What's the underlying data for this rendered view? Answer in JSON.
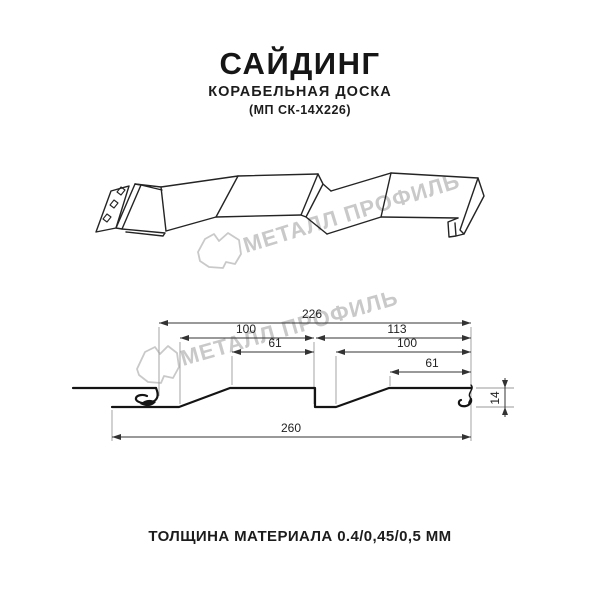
{
  "header": {
    "title": "САЙДИНГ",
    "subtitle": "КОРАБЕЛЬНАЯ ДОСКА",
    "model": "(МП СК-14Х226)"
  },
  "watermark": {
    "text": "МЕТАЛЛ ПРОФИЛЬ",
    "color": "#c9c9c9"
  },
  "section": {
    "dims": {
      "total": "226",
      "pitch_left": "100",
      "flat_left": "61",
      "pitch_right": "113",
      "inner_right": "100",
      "flat_right": "61",
      "overall": "260",
      "height": "14"
    }
  },
  "footer": {
    "thickness": "ТОЛЩИНА МАТЕРИАЛА 0.4/0,45/0,5 ММ"
  },
  "colors": {
    "profile_line": "#141414",
    "dimension_line": "#333333",
    "extension_line": "#9a9a9a",
    "watermark": "#c9c9c9",
    "background": "#ffffff"
  }
}
